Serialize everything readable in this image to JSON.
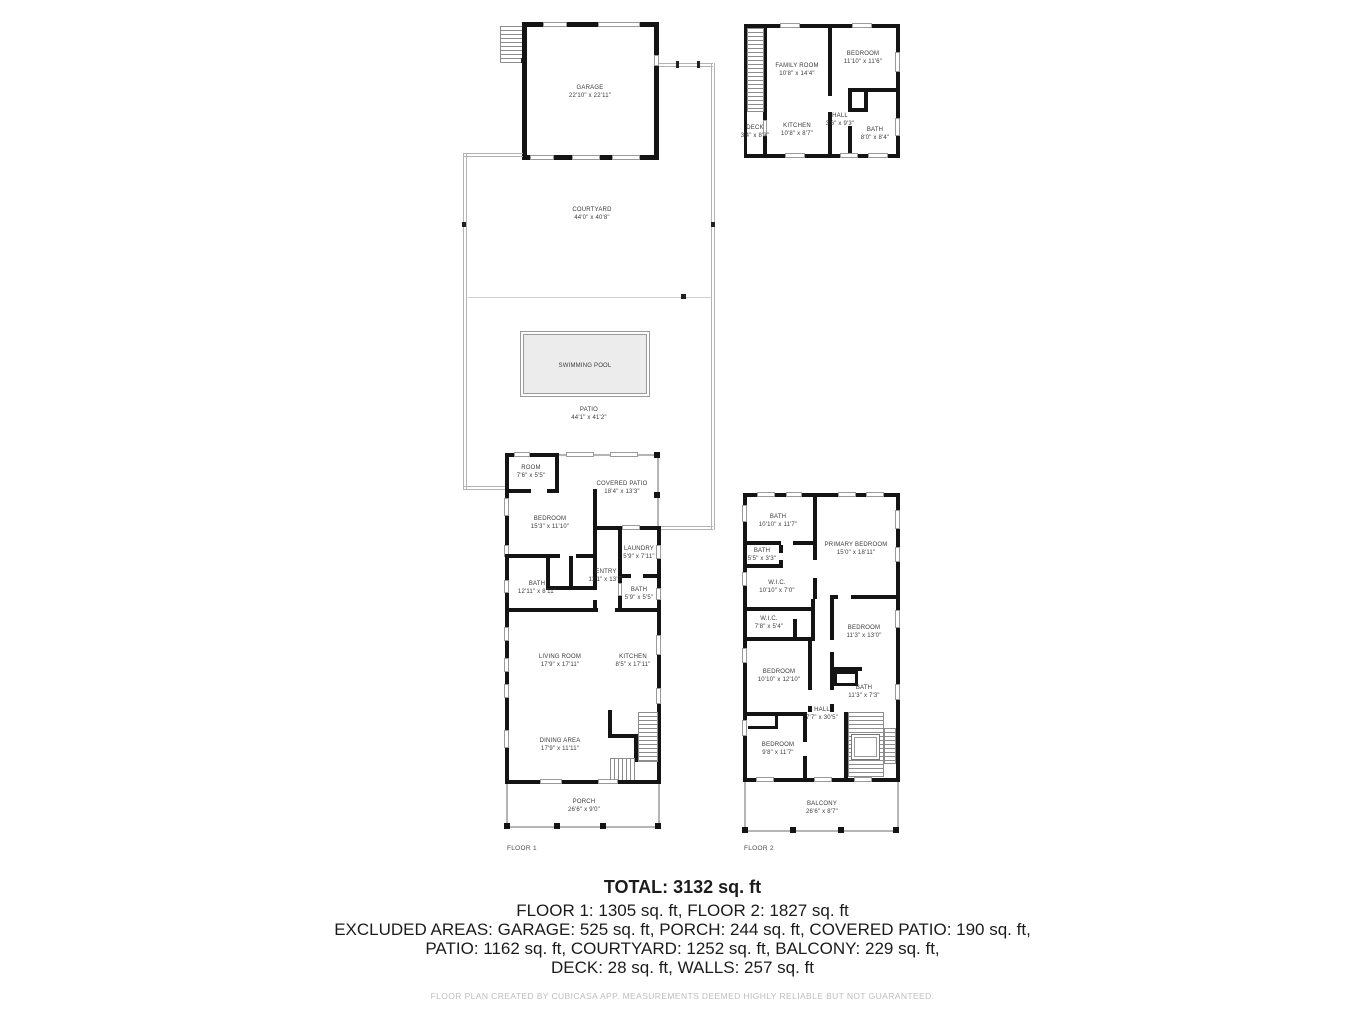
{
  "garage_plan": {
    "rooms": [
      {
        "name": "GARAGE",
        "dims": "22'10\" x 22'11\""
      }
    ]
  },
  "adu_plan": {
    "rooms": [
      {
        "name": "FAMILY ROOM",
        "dims": "10'8\" x 14'4\""
      },
      {
        "name": "BEDROOM",
        "dims": "11'10\" x 11'6\""
      },
      {
        "name": "KITCHEN",
        "dims": "10'8\" x 8'7\""
      },
      {
        "name": "HALL",
        "dims": "3'6\" x 9'3\""
      },
      {
        "name": "BATH",
        "dims": "8'0\" x 8'4\""
      },
      {
        "name": "DECK",
        "dims": "3'4\" x 8'3\""
      }
    ]
  },
  "site": {
    "courtyard": {
      "name": "COURTYARD",
      "dims": "44'0\" x 40'8\""
    },
    "patio": {
      "name": "PATIO",
      "dims": "44'1\" x 41'2\""
    },
    "pool": {
      "name": "SWIMMING POOL"
    }
  },
  "floor1": {
    "label": "FLOOR 1",
    "rooms": [
      {
        "name": "ROOM",
        "dims": "7'6\" x 5'5\""
      },
      {
        "name": "COVERED PATIO",
        "dims": "18'4\" x 13'3\""
      },
      {
        "name": "BEDROOM",
        "dims": "15'3\" x 11'10\""
      },
      {
        "name": "LAUNDRY",
        "dims": "5'9\" x 7'11\""
      },
      {
        "name": "ENTRY",
        "dims": "11'1\" x 13'7\""
      },
      {
        "name": "BATH",
        "dims": "12'11\" x 8'11\""
      },
      {
        "name": "BATH",
        "dims": "5'9\" x 5'5\""
      },
      {
        "name": "LIVING ROOM",
        "dims": "17'9\" x 17'11\""
      },
      {
        "name": "KITCHEN",
        "dims": "8'5\" x 17'11\""
      },
      {
        "name": "DINING AREA",
        "dims": "17'9\" x 11'11\""
      },
      {
        "name": "PORCH",
        "dims": "26'6\" x 9'0\""
      }
    ]
  },
  "floor2": {
    "label": "FLOOR 2",
    "rooms": [
      {
        "name": "BATH",
        "dims": "10'10\" x 11'7\""
      },
      {
        "name": "BATH",
        "dims": "5'5\" x 3'3\""
      },
      {
        "name": "W.I.C.",
        "dims": "10'10\" x 7'0\""
      },
      {
        "name": "PRIMARY BEDROOM",
        "dims": "15'0\" x 18'11\""
      },
      {
        "name": "W.I.C.",
        "dims": "7'8\" x 5'4\""
      },
      {
        "name": "BEDROOM",
        "dims": "11'3\" x 13'0\""
      },
      {
        "name": "BEDROOM",
        "dims": "10'10\" x 12'10\""
      },
      {
        "name": "BATH",
        "dims": "11'3\" x 7'3\""
      },
      {
        "name": "HALL",
        "dims": "7'7\" x 30'5\""
      },
      {
        "name": "BEDROOM",
        "dims": "9'8\" x 11'7\""
      },
      {
        "name": "BALCONY",
        "dims": "26'6\" x 8'7\""
      }
    ]
  },
  "summary": {
    "total": "TOTAL: 3132 sq. ft",
    "line2": "FLOOR 1: 1305 sq. ft, FLOOR 2: 1827 sq. ft",
    "line3": "EXCLUDED AREAS: GARAGE: 525 sq. ft, PORCH: 244 sq. ft, COVERED PATIO: 190 sq. ft,",
    "line4": "PATIO: 1162 sq. ft, COURTYARD: 1252 sq. ft, BALCONY: 229 sq. ft,",
    "line5": "DECK: 28 sq. ft, WALLS: 257 sq. ft",
    "disclaimer": "FLOOR PLAN CREATED BY CUBICASA APP. MEASUREMENTS DEEMED HIGHLY RELIABLE BUT NOT GUARANTEED."
  }
}
